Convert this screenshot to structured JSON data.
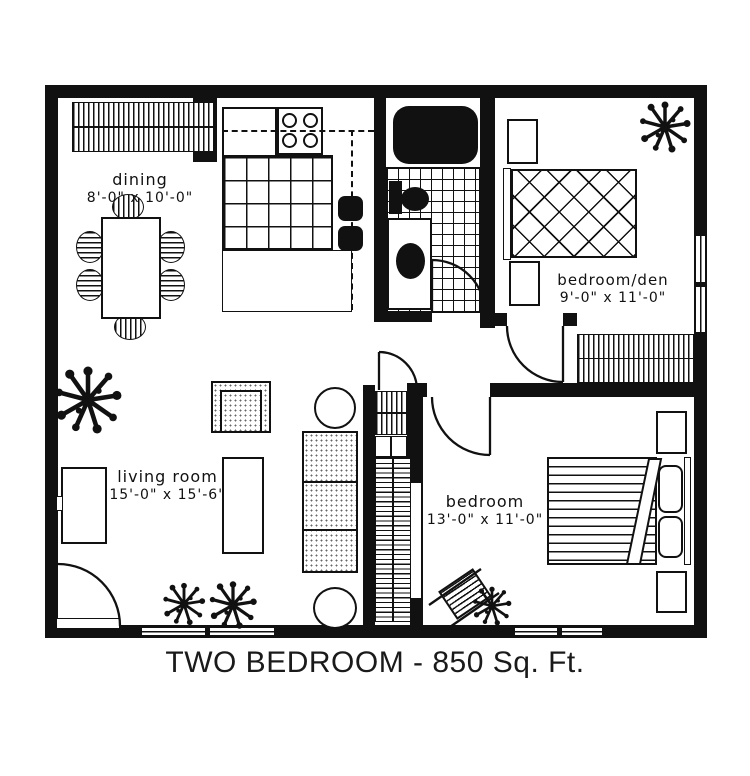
{
  "title": "TWO BEDROOM - 850 Sq. Ft.",
  "rooms": {
    "dining": {
      "name": "dining",
      "dimensions": "8'-0\" x 10'-0\""
    },
    "living_room": {
      "name": "living room",
      "dimensions": "15'-0\" x 15'-6\""
    },
    "bedroom_den": {
      "name": "bedroom/den",
      "dimensions": "9'-0\" x 11'-0\""
    },
    "bedroom": {
      "name": "bedroom",
      "dimensions": "13'-0\" x 11'-0\""
    }
  },
  "colors": {
    "wall": "#111111",
    "floor": "#ffffff"
  }
}
